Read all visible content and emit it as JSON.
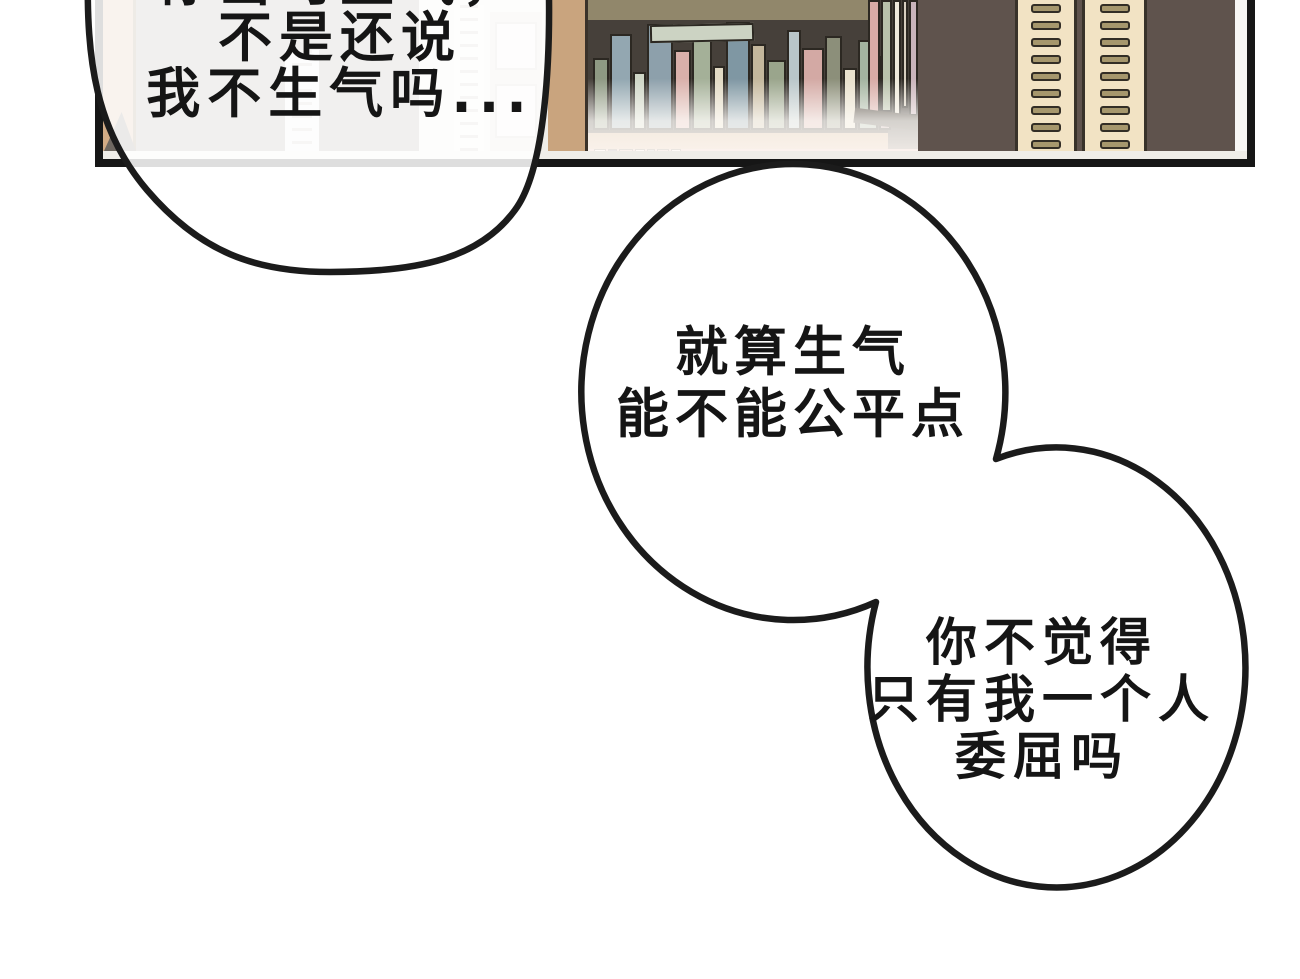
{
  "page": {
    "background_color": "#ffffff",
    "type": "comic-page"
  },
  "bubbles": {
    "top_left": {
      "line1_top_cropped": "你当时生气，",
      "line2": "不是还说",
      "line3": "我不生气吗..."
    },
    "middle": {
      "line1": "就算生气",
      "line2": "能不能公平点"
    },
    "bottom_right": {
      "line1": "你不觉得",
      "line2": "只有我一个人",
      "line3": "委屈吗"
    },
    "outline_color": "#1b1b1b",
    "fill_color": "#ffffff",
    "text_color": "#151515"
  },
  "scene": {
    "panel": {
      "border_color": "#161616",
      "left_strip_color": "#d2ab85",
      "corner_triangle_color": "#6f6861",
      "backdrop_left_color": "#9a958e",
      "light_window_color": "#efede8",
      "shelf_frame_color": "#c9a47e",
      "shelf_interior_color": "#46403a",
      "shelf_top_band_color": "#91876b",
      "shelf_plank_color": "#c9a47e",
      "angled_plank_color": "#41392f",
      "bottom_band_color": "#d8a8a3",
      "dark_wall_right_color": "#5f534d",
      "tower_color": "#f2e3c4",
      "tower_slot_fill": "#a6976d",
      "tower_slot_border": "#332e26",
      "white_sliver_color": "#f7f6f4"
    },
    "bookshelf": {
      "main_books": [
        {
          "w": 16,
          "h": 72,
          "c": "#8e9983"
        },
        {
          "w": 22,
          "h": 96,
          "c": "#93a7b1"
        },
        {
          "w": 13,
          "h": 58,
          "c": "#cfd6c6"
        },
        {
          "w": 26,
          "h": 106,
          "c": "#8da0ab"
        },
        {
          "w": 17,
          "h": 80,
          "c": "#d9b0aa"
        },
        {
          "w": 20,
          "h": 98,
          "c": "#a4b098"
        },
        {
          "w": 12,
          "h": 64,
          "c": "#e2dac4"
        },
        {
          "w": 24,
          "h": 108,
          "c": "#7f97a3"
        },
        {
          "w": 15,
          "h": 86,
          "c": "#c4b79c"
        },
        {
          "w": 19,
          "h": 70,
          "c": "#9aa58c"
        },
        {
          "w": 14,
          "h": 100,
          "c": "#b9c6c9"
        },
        {
          "w": 22,
          "h": 82,
          "c": "#d3a9a4"
        },
        {
          "w": 17,
          "h": 94,
          "c": "#8c8f7a"
        },
        {
          "w": 14,
          "h": 62,
          "c": "#e8e0cc"
        },
        {
          "w": 20,
          "h": 90,
          "c": "#a3b4a0"
        },
        {
          "w": 12,
          "h": 74,
          "c": "#b59c9c"
        }
      ],
      "right_books": [
        {
          "w": 12,
          "h": 118,
          "c": "#d8aba6"
        },
        {
          "w": 11,
          "h": 112,
          "c": "#b9c2ab"
        },
        {
          "w": 8,
          "h": 120,
          "c": "#efe9db"
        },
        {
          "w": 6,
          "h": 108,
          "c": "#d8cfc0"
        },
        {
          "w": 9,
          "h": 116,
          "c": "#c9b4bb"
        }
      ],
      "bottom_books": [
        {
          "w": 12,
          "c": "#ffffff"
        },
        {
          "w": 9,
          "c": "#44406b"
        },
        {
          "w": 14,
          "c": "#d8a8a3"
        },
        {
          "w": 10,
          "c": "#ffffff"
        },
        {
          "w": 8,
          "c": "#8da0ab"
        },
        {
          "w": 12,
          "c": "#d3a9a4"
        },
        {
          "w": 10,
          "c": "#ffffff"
        }
      ],
      "lying_book_color": "#ccd3c3"
    },
    "towers": {
      "slot_rows": 9,
      "count": 2
    }
  }
}
